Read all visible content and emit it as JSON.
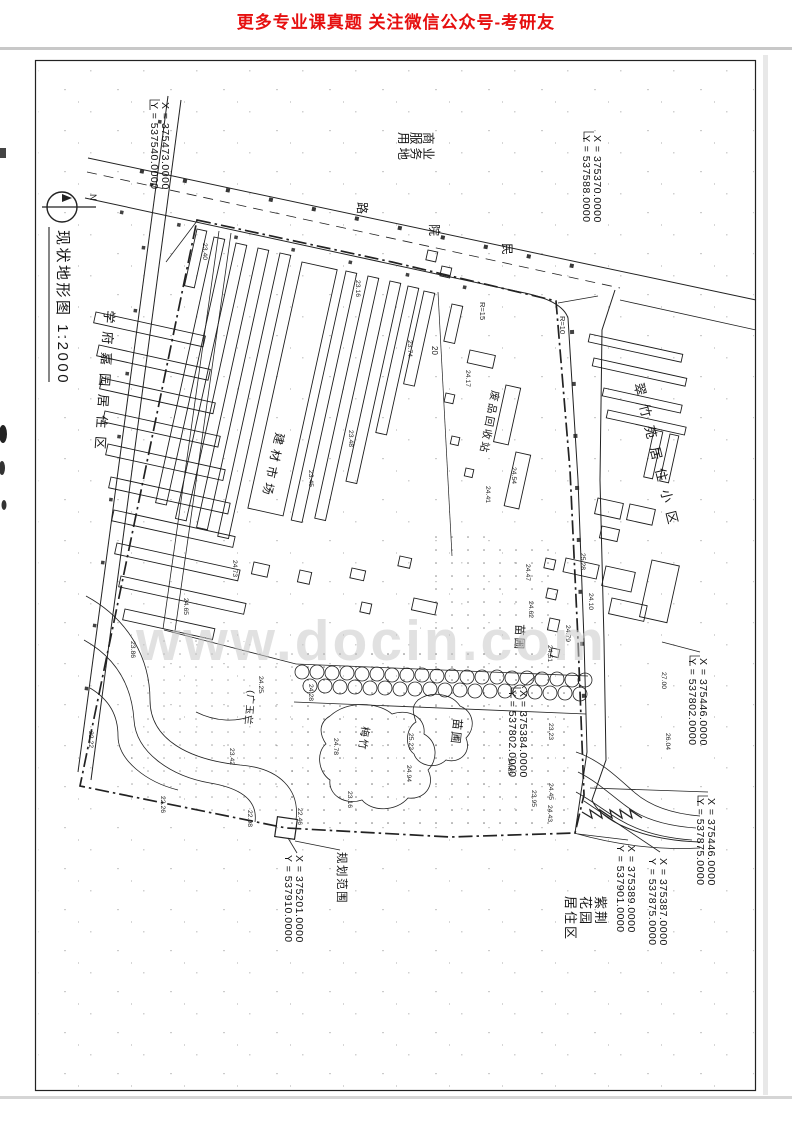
{
  "header": {
    "promo_text": "更多专业课真题 关注微信公众号-考研友"
  },
  "watermark": {
    "text": "www.docin.com"
  },
  "map": {
    "title": "现状地形图 1:2000",
    "north_label": "N",
    "labels": {
      "commercial_l1": "商业",
      "commercial_l2": "服务",
      "commercial_l3": "用地",
      "road_char_1": "民",
      "road_char_2": "院",
      "road_char_3": "路",
      "xuefu": "学府嘉园居住区",
      "cuizhu": "翠竹苑居住小区",
      "market": "建材市场",
      "recycle": "废品回收站",
      "nursery_a": "苗圃",
      "nursery_b": "苗圃",
      "bamboo": "梅竹",
      "magnolia": "(广玉兰",
      "zijing_l1": "紫荆",
      "zijing_l2": "花园",
      "zijing_l3": "居住区",
      "boundary": "规划范围",
      "radius_1": "R=15",
      "radius_2": "R=10",
      "road_width": "20"
    },
    "coords": {
      "tl_x": "X = 375473.0000",
      "tl_y": "Y = 537540.0000",
      "tr_x": "X = 375370.0000",
      "tr_y": "Y = 537588.0000",
      "mc_x": "X = 375384.0000",
      "mc_y": "Y = 537802.0000",
      "mr_x": "X = 375446.0000",
      "mr_y": "Y = 537802.0000",
      "bl_x": "X = 375201.0000",
      "bl_y": "Y = 537910.0000",
      "br1_x": "X = 375446.0000",
      "br1_y": "Y = 537875.0000",
      "br2_x": "X = 375387.0000",
      "br2_y": "Y = 537875.0000",
      "br3_x": "X = 375389.0000",
      "br3_y": "Y = 537901.0000"
    },
    "spots": [
      {
        "v": "23.40"
      },
      {
        "v": "23.16"
      },
      {
        "v": "23.74"
      },
      {
        "v": "24.17"
      },
      {
        "v": "23.48"
      },
      {
        "v": "23.45"
      },
      {
        "v": "24.54"
      },
      {
        "v": "24.41"
      },
      {
        "v": "24.47"
      },
      {
        "v": "24.62"
      },
      {
        "v": "25.28"
      },
      {
        "v": "24.10"
      },
      {
        "v": "24.79"
      },
      {
        "v": "24.51"
      },
      {
        "v": "24.73"
      },
      {
        "v": "24.65"
      },
      {
        "v": "23.86"
      },
      {
        "v": "24.25"
      },
      {
        "v": "24.28"
      },
      {
        "v": "24.78"
      },
      {
        "v": "25.22"
      },
      {
        "v": "24.94"
      },
      {
        "v": "23.23"
      },
      {
        "v": "24.89"
      },
      {
        "v": "23.95"
      },
      {
        "v": "24.45"
      },
      {
        "v": "24.43"
      },
      {
        "v": "22.22"
      },
      {
        "v": "23.42"
      },
      {
        "v": "22.98"
      },
      {
        "v": "23.16"
      },
      {
        "v": "22.46"
      },
      {
        "v": "22.26"
      },
      {
        "v": "27.00"
      },
      {
        "v": "26.04"
      }
    ]
  },
  "colors": {
    "promo_red": "#e60f0f",
    "ink": "#1b1b1b",
    "watermark_gray": "#c9c9c9"
  }
}
